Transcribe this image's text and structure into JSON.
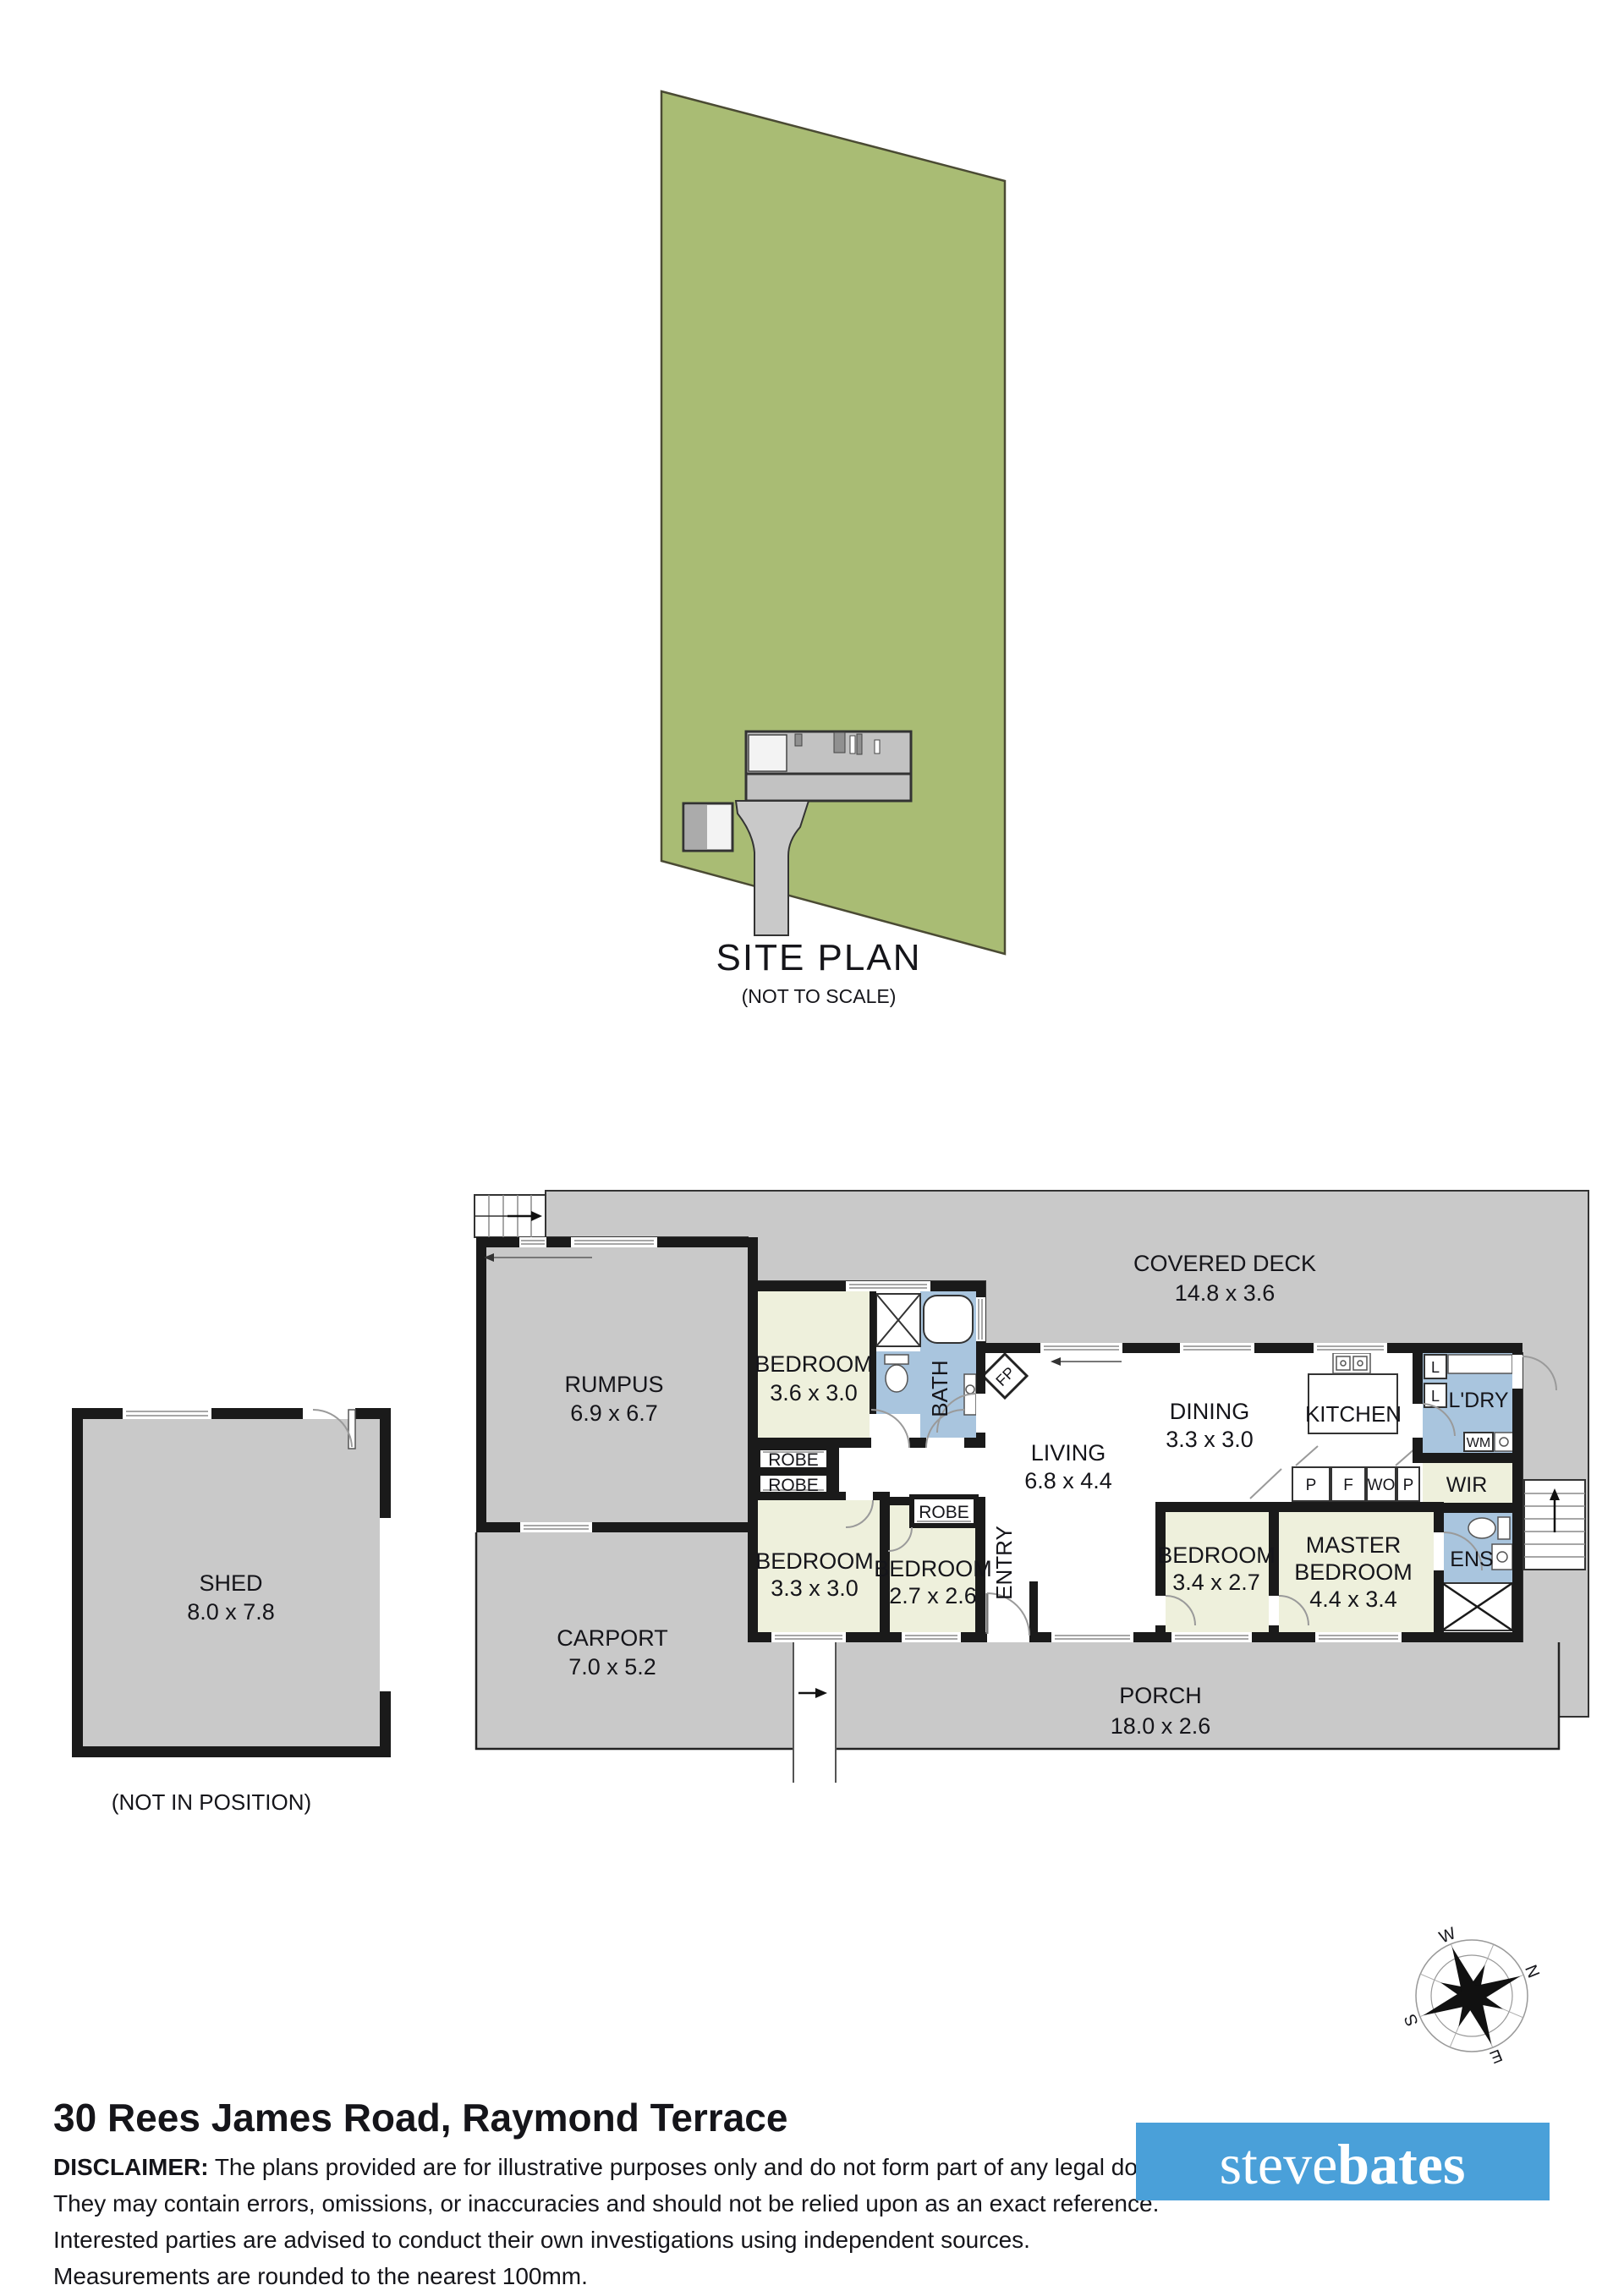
{
  "site_plan": {
    "title": "SITE PLAN",
    "scale_note": "(NOT TO SCALE)"
  },
  "rooms": {
    "rumpus": {
      "name": "RUMPUS",
      "dims": "6.9 x 6.7"
    },
    "bedroom_1": {
      "name": "BEDROOM",
      "dims": "3.6 x 3.0"
    },
    "bath": {
      "name": "BATH"
    },
    "fireplace": {
      "abbr": "FP"
    },
    "covered_deck": {
      "name": "COVERED DECK",
      "dims": "14.8 x 3.6"
    },
    "dining": {
      "name": "DINING",
      "dims": "3.3 x 3.0"
    },
    "kitchen": {
      "name": "KITCHEN"
    },
    "laundry": {
      "name": "L'DRY"
    },
    "living": {
      "name": "LIVING",
      "dims": "6.8 x 4.4"
    },
    "entry": {
      "name": "ENTRY"
    },
    "bedroom_2": {
      "name": "BEDROOM",
      "dims": "3.3 x 3.0"
    },
    "bedroom_3": {
      "name": "BEDROOM",
      "dims": "2.7 x 2.6"
    },
    "bedroom_4": {
      "name": "BEDROOM",
      "dims": "3.4 x 2.7"
    },
    "master_bedroom": {
      "line1": "MASTER",
      "line2": "BEDROOM",
      "dims": "4.4 x 3.4"
    },
    "wir": {
      "name": "WIR"
    },
    "ens": {
      "name": "ENS"
    },
    "porch": {
      "name": "PORCH",
      "dims": "18.0 x 2.6"
    },
    "carport": {
      "name": "CARPORT",
      "dims": "7.0 x 5.2"
    },
    "shed": {
      "name": "SHED",
      "dims": "8.0 x 7.8",
      "note": "(NOT IN POSITION)"
    },
    "robe": {
      "name": "ROBE"
    },
    "linen": {
      "abbr": "L"
    },
    "washing_machine": {
      "abbr": "WM"
    },
    "pantry": {
      "abbr": "P"
    },
    "fridge": {
      "abbr": "F"
    },
    "wall_oven": {
      "abbr": "WO"
    }
  },
  "compass": {
    "north": "N",
    "east": "E",
    "south": "S",
    "west": "W"
  },
  "footer": {
    "address": "30 Rees James Road, Raymond Terrace",
    "disclaimer_label": "DISCLAIMER:",
    "disclaimer_line1": " The plans provided are for illustrative purposes only and do not form part of any legal document or title.",
    "disclaimer_lines": [
      "They may contain errors, omissions, or inaccuracies and should not be relied upon as an exact reference.",
      "Interested parties are advised to conduct their own investigations using independent sources.",
      "Measurements are rounded to the nearest 100mm."
    ],
    "logo": {
      "first": "steve",
      "second": "bates"
    }
  },
  "colors": {
    "site_green": "#a9bc74",
    "plan_gray": "#c9c9c9",
    "room_cream": "#eef0dc",
    "wet_area_blue": "#a9c5de",
    "wall_black": "#1a1a1a",
    "logo_blue": "#4aa0d9"
  }
}
